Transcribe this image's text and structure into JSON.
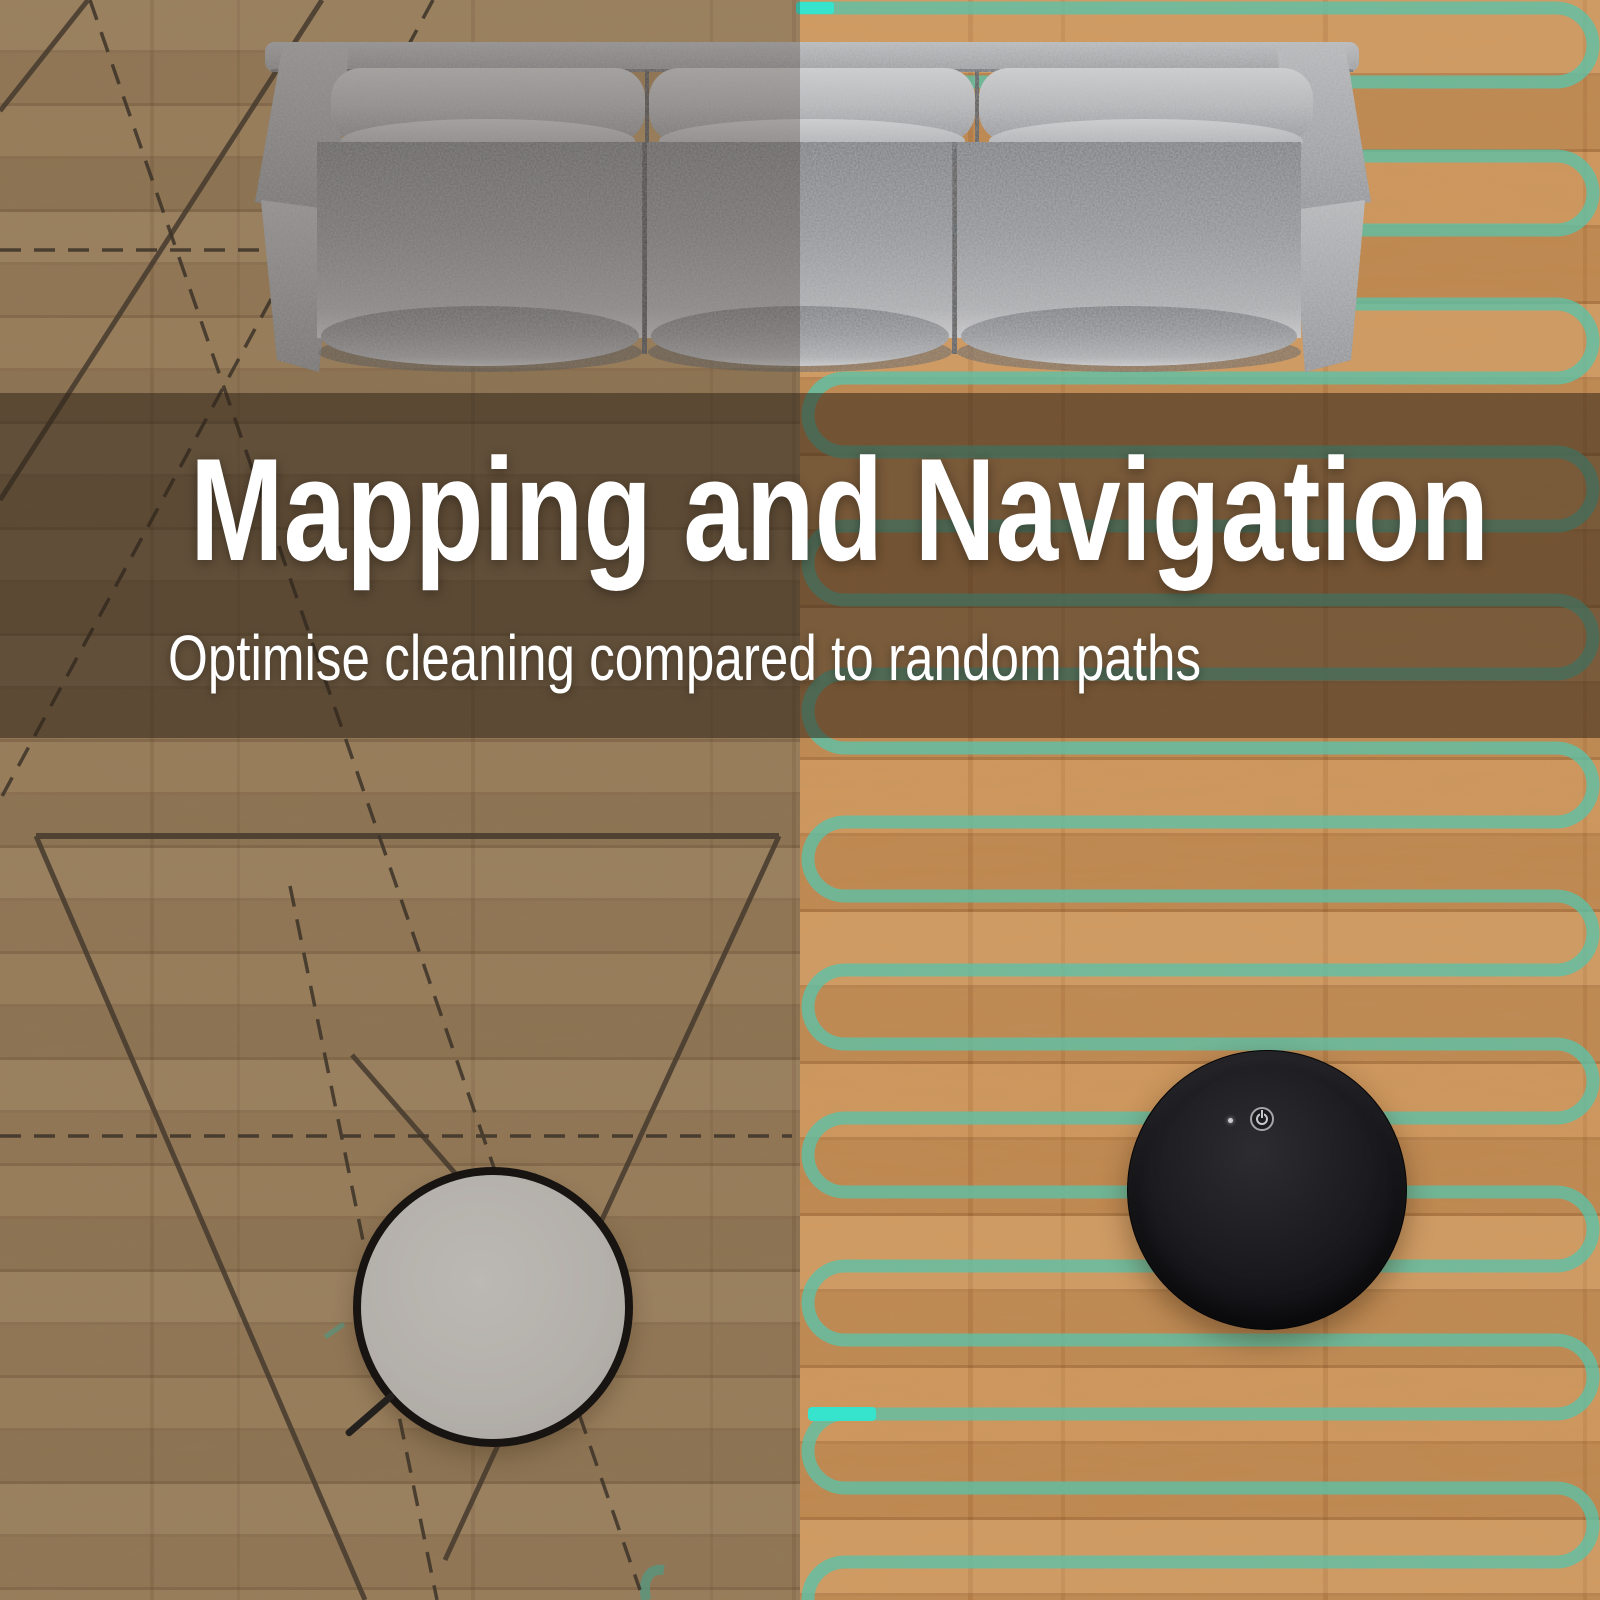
{
  "hero": {
    "title": "Mapping and Navigation",
    "subtitle": "Optimise cleaning compared to random paths"
  },
  "icons": {
    "power": "power-icon",
    "led": "led-indicator-icon"
  },
  "colors": {
    "mapped_path_teal": "#5ec1a6",
    "path_start_marker_cyan": "#36e3cd",
    "random_path_dark": "#4b4033",
    "banner_overlay": "rgba(47,36,25,0.53)",
    "floor_right_wood": "#cb9257",
    "floor_left_wood": "#bb9a6e",
    "sofa_gray": "#9a9b9e",
    "robot_black_body": "#1d1d22",
    "robot_white_body": "#e2e0dd",
    "headline_text": "#ffffff"
  }
}
